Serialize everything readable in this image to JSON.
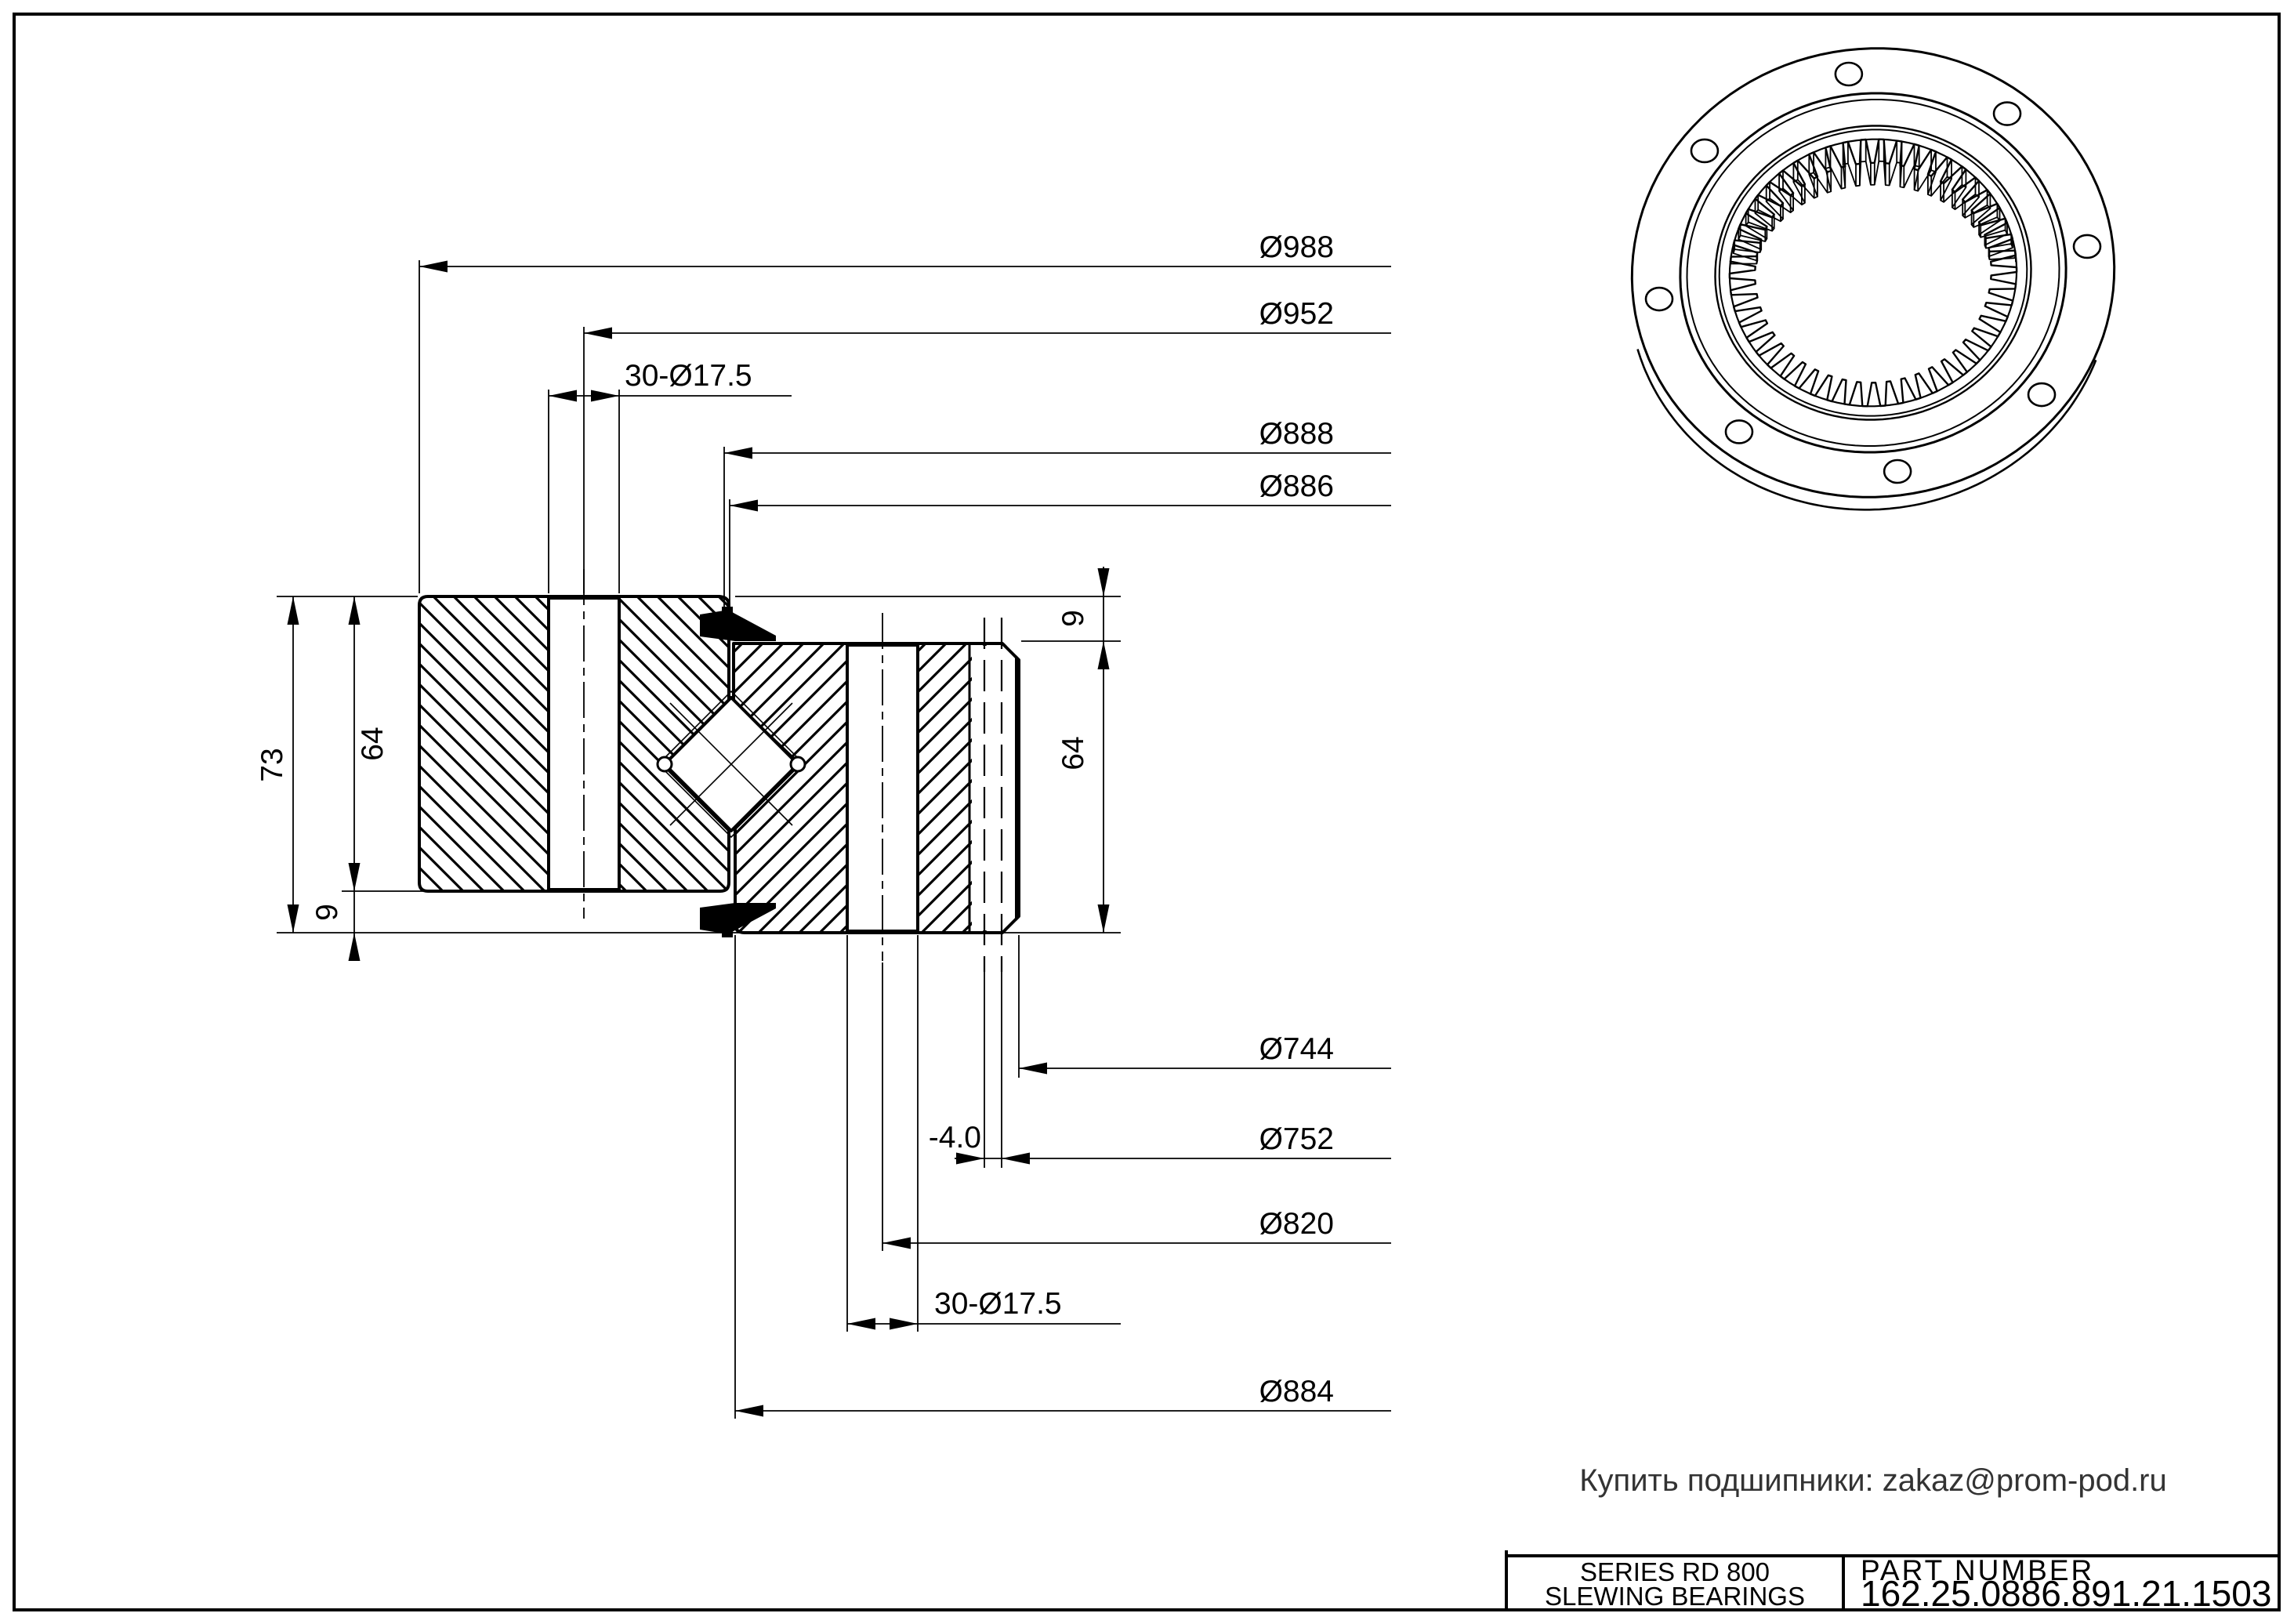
{
  "drawing": {
    "note": "Купить подшипники: zakaz@prom-pod.ru",
    "title_block": {
      "series_line1": "SERIES  RD  800",
      "series_line2": "SLEWING BEARINGS",
      "part_number_label": "PART  NUMBER",
      "part_number": "162.25.0886.891.21.1503"
    },
    "dimensions": {
      "top": {
        "d988": "Ø988",
        "d952": "Ø952",
        "holes_top": "30-Ø17.5",
        "d888": "Ø888",
        "d886": "Ø886"
      },
      "bottom": {
        "d744": "Ø744",
        "offset": "-4.0",
        "d752": "Ø752",
        "d820": "Ø820",
        "holes_bottom": "30-Ø17.5",
        "d884": "Ø884"
      },
      "left": {
        "h73": "73",
        "h64": "64",
        "h9": "9"
      },
      "right": {
        "h9": "9",
        "h64": "64"
      }
    },
    "iso": {
      "teeth_count": 50,
      "bolt_holes": 8
    },
    "colors": {
      "line": "#000000",
      "note_text": "#333333",
      "background": "#ffffff"
    }
  }
}
